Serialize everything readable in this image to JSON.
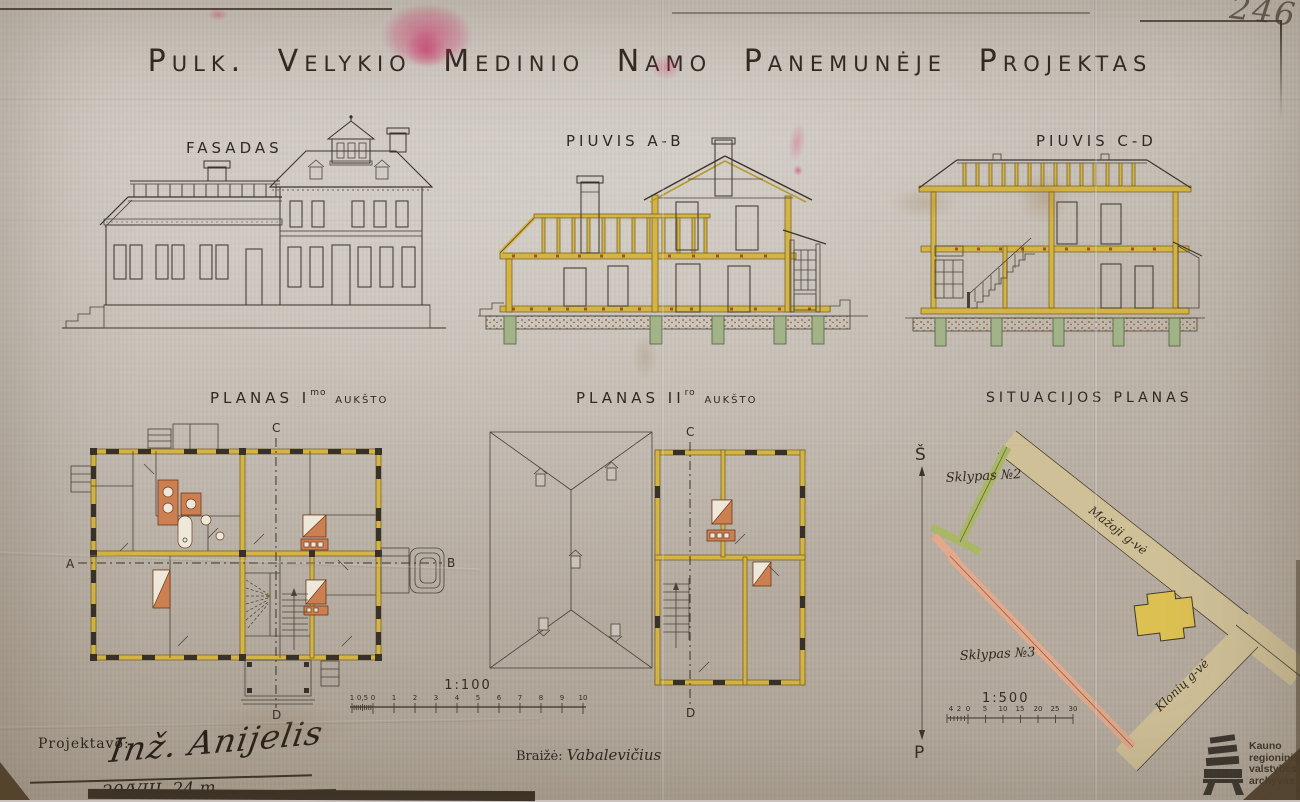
{
  "page": {
    "corner_number": "246",
    "title": "Pulk. Velykio Medinio Namo Panemunėje Projektas"
  },
  "sections": {
    "fasadas": {
      "label": "FASADAS"
    },
    "piuvis_ab": {
      "label": "PIUVIS A-B"
    },
    "piuvis_cd": {
      "label": "PIUVIS C-D"
    },
    "planas1": {
      "label": "PLANAS I",
      "sup": "mo",
      "suffix": "AUKŠTO",
      "marker_a": "A",
      "marker_b": "B",
      "marker_c": "C",
      "marker_d": "D"
    },
    "planas2": {
      "label": "PLANAS II",
      "sup": "ro",
      "suffix": "AUKŠTO",
      "marker_c": "C",
      "marker_d": "D"
    },
    "situacija": {
      "label": "SITUACIJOS PLANAS",
      "north": "Š",
      "south": "P",
      "plot2": "Sklypas №2",
      "plot3": "Sklypas №3",
      "street_upper": "Mažoji g-vė",
      "street_lower": "Klonių g-vė"
    }
  },
  "scales": {
    "s100": {
      "label": "1:100",
      "ticks": [
        "1",
        "0,5",
        "0",
        "1",
        "2",
        "3",
        "4",
        "5",
        "6",
        "7",
        "8",
        "9",
        "10"
      ]
    },
    "s500": {
      "label": "1:500",
      "ticks": [
        "4",
        "2",
        "0",
        "5",
        "10",
        "15",
        "20",
        "25",
        "30"
      ]
    }
  },
  "credits": {
    "designed_label": "Projektavo:",
    "designed_signature": "Inž. Anijelis",
    "date": "20/VIII. 24 m.",
    "drawn_label": "Braižė:",
    "drawn_signature": "Vabalevičius"
  },
  "stamp": {
    "line1": "Kauno",
    "line2": "regioninis",
    "line3": "valstybės",
    "line4": "archyvas"
  },
  "colors": {
    "paper": "#c6bfb7",
    "ink": "#2f2822",
    "ochre": "#d4b445",
    "pier_green": "#a3b388",
    "ground": "#d9a75f",
    "stove": "#cc7f50",
    "road": "#cfc098",
    "plot_green": "#aab766",
    "plot_pink": "#e2a98c",
    "stain_pink": "#d93574"
  }
}
